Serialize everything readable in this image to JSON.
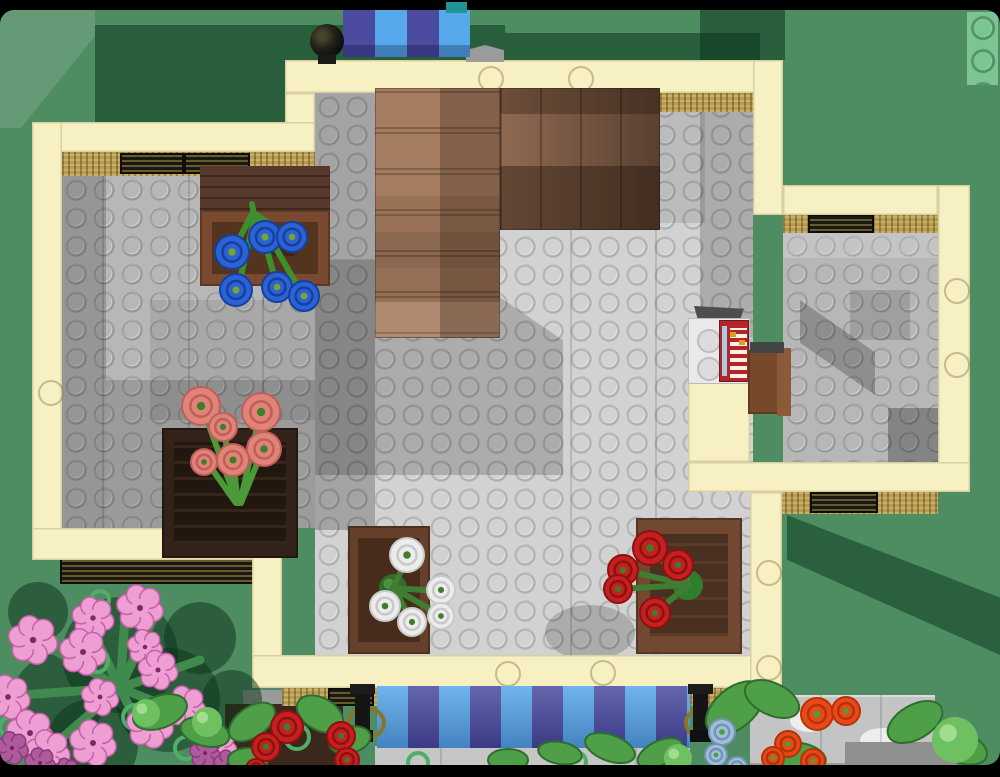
{
  "scene": {
    "title": "Top-down LEGO render of a flower shop ground floor on a green baseplate",
    "palette": {
      "frame_black": "#000000",
      "grass_green": "#4e8c62",
      "grass_shadow_green": "#14502c",
      "grass_light_green": "#7cc492",
      "wall_cream": "#f6f0c3",
      "sill_tan": "#b79a4e",
      "window_slot_dark": "#191814",
      "floor_light_gray": "#d2d2d2",
      "floor_mid_gray": "#b7b7b7",
      "stairs_light_brown": "#a67c60",
      "stairs_dark_brown": "#5a4030",
      "crate_brown": "#6b4128",
      "awning_blue": "#57a8ea",
      "awning_violet": "#4b4ba0",
      "flower_blue": "#2b62d4",
      "flower_pink_rose": "#e08378",
      "flower_white": "#ececec",
      "flower_red": "#c42020",
      "flower_orange": "#e8481a",
      "flower_magenta": "#ef9ed4",
      "flower_light_blue": "#9fc0dc",
      "leaf_green": "#4f9e48",
      "register_red": "#b22528",
      "register_white": "#e9e9e9"
    },
    "objects": [
      "green studded baseplate",
      "cream shop walls",
      "gray tiled floor",
      "L-shaped brown staircase",
      "table with blue flowers",
      "crate with pink roses",
      "crate with white roses",
      "crate with red roses",
      "red cash register on counter",
      "wooden stool",
      "blue and violet striped awnings",
      "black street lamps",
      "pink blossom bush",
      "orange flowers",
      "light blue flowers",
      "stone wall"
    ],
    "flower_counts": {
      "blue": 6,
      "pink_roses": 6,
      "white": 5,
      "red_in_crate": 5,
      "red_outside": 5,
      "pink_blossoms": 14,
      "purple_blossoms": 5,
      "orange": 5,
      "light_blue": 3
    }
  },
  "clusters": [
    {
      "name": "bush-ground-shadow",
      "type": "blob",
      "color": "rgba(10,48,24,0.5)",
      "items": [
        [
          120,
          655,
          58
        ],
        [
          58,
          700,
          46
        ],
        [
          168,
          700,
          52
        ],
        [
          92,
          745,
          46
        ],
        [
          200,
          638,
          36
        ],
        [
          38,
          612,
          30
        ],
        [
          232,
          700,
          30
        ]
      ]
    },
    {
      "name": "bush-branches",
      "type": "branch",
      "color": "#3f8a4c",
      "width": 9,
      "items": [
        [
          120,
          688,
          40,
          642
        ],
        [
          120,
          688,
          88,
          622
        ],
        [
          120,
          688,
          155,
          615
        ],
        [
          120,
          688,
          200,
          660
        ],
        [
          120,
          688,
          196,
          718
        ],
        [
          120,
          688,
          148,
          745
        ],
        [
          120,
          688,
          62,
          738
        ],
        [
          120,
          688,
          20,
          695
        ],
        [
          120,
          688,
          126,
          602
        ]
      ]
    },
    {
      "name": "plant-rings",
      "type": "ring",
      "color": "#4fae68",
      "width": 4,
      "items": [
        [
          97,
          661,
          11
        ],
        [
          135,
          717,
          12
        ],
        [
          186,
          748,
          11
        ],
        [
          10,
          727,
          10
        ],
        [
          100,
          600,
          9
        ],
        [
          297,
          737,
          12
        ],
        [
          418,
          763,
          10
        ],
        [
          576,
          762,
          10
        ],
        [
          652,
          768,
          9
        ]
      ]
    },
    {
      "name": "pink-blossoms",
      "type": "daisy",
      "color": "#ef9ed4",
      "ring": "#c560a8",
      "hole": "#7c2a66",
      "items": [
        [
          140,
          608,
          20
        ],
        [
          93,
          618,
          18
        ],
        [
          33,
          640,
          21
        ],
        [
          83,
          652,
          20
        ],
        [
          145,
          647,
          15
        ],
        [
          158,
          670,
          17
        ],
        [
          8,
          697,
          19
        ],
        [
          100,
          697,
          16
        ],
        [
          185,
          707,
          18
        ],
        [
          150,
          725,
          20
        ],
        [
          30,
          733,
          20
        ],
        [
          93,
          743,
          20
        ],
        [
          48,
          752,
          19
        ],
        [
          217,
          747,
          17
        ]
      ]
    },
    {
      "name": "purple-blossoms",
      "type": "daisy",
      "color": "#b05a9e",
      "ring": "#8a3a78",
      "hole": "#6e2858",
      "items": [
        [
          12,
          748,
          14
        ],
        [
          40,
          763,
          13
        ],
        [
          205,
          753,
          13
        ],
        [
          228,
          764,
          12
        ],
        [
          66,
          771,
          11
        ]
      ]
    },
    {
      "name": "leaves",
      "type": "leaf",
      "color": "#4f9e48",
      "stroke": "#2d6e30",
      "items": [
        [
          160,
          712,
          28,
          16,
          -20
        ],
        [
          205,
          732,
          25,
          14,
          15
        ],
        [
          252,
          722,
          26,
          15,
          -35
        ],
        [
          320,
          714,
          25,
          16,
          30
        ],
        [
          350,
          740,
          21,
          13,
          -15
        ],
        [
          610,
          748,
          26,
          13,
          20
        ],
        [
          660,
          753,
          24,
          12,
          -25
        ],
        [
          735,
          708,
          34,
          20,
          -40
        ],
        [
          772,
          699,
          29,
          16,
          25
        ],
        [
          800,
          757,
          26,
          14,
          10
        ],
        [
          915,
          722,
          30,
          17,
          -30
        ],
        [
          962,
          748,
          26,
          15,
          20
        ],
        [
          508,
          760,
          20,
          11,
          0
        ],
        [
          560,
          753,
          22,
          11,
          10
        ],
        [
          248,
          760,
          20,
          12,
          0
        ]
      ]
    },
    {
      "name": "leaf-balls",
      "type": "ball",
      "color": "#6fc060",
      "hi": "#a2dc8e",
      "items": [
        [
          955,
          740,
          23
        ],
        [
          207,
          722,
          15
        ],
        [
          146,
          713,
          14
        ],
        [
          678,
          758,
          14
        ]
      ]
    },
    {
      "name": "blue-flower-stems",
      "type": "branch",
      "color": "#3f8f2f",
      "width": 6,
      "items": [
        [
          253,
          212,
          233,
          251
        ],
        [
          255,
          214,
          289,
          238
        ],
        [
          255,
          216,
          238,
          288
        ],
        [
          258,
          218,
          277,
          286
        ],
        [
          260,
          220,
          302,
          294
        ],
        [
          252,
          204,
          256,
          226
        ]
      ]
    },
    {
      "name": "blue-flowers",
      "type": "rose",
      "color": "#2b62d4",
      "ring": "#163f9e",
      "center": "#79a52c",
      "items": [
        [
          232,
          252,
          17
        ],
        [
          265,
          237,
          16
        ],
        [
          292,
          237,
          15
        ],
        [
          236,
          290,
          16
        ],
        [
          277,
          287,
          15
        ],
        [
          304,
          296,
          15
        ]
      ]
    },
    {
      "name": "pink-rose-stems",
      "type": "branch",
      "color": "#4a9a37",
      "width": 6,
      "items": [
        [
          237,
          503,
          203,
          409
        ],
        [
          238,
          503,
          223,
          428
        ],
        [
          240,
          503,
          260,
          414
        ],
        [
          241,
          503,
          263,
          449
        ],
        [
          238,
          503,
          233,
          460
        ],
        [
          236,
          503,
          207,
          462
        ]
      ]
    },
    {
      "name": "pink-roses",
      "type": "rose",
      "color": "#e08378",
      "ring": "#bf5f58",
      "center": "#3e7d2a",
      "items": [
        [
          201,
          406,
          19
        ],
        [
          223,
          427,
          14
        ],
        [
          261,
          412,
          19
        ],
        [
          264,
          449,
          17
        ],
        [
          233,
          460,
          16
        ],
        [
          204,
          462,
          13
        ]
      ]
    },
    {
      "name": "white-flower-hub",
      "type": "ball",
      "color": "#2f6e2a",
      "hi": "#4e8f45",
      "items": [
        [
          393,
          588,
          14
        ]
      ]
    },
    {
      "name": "white-flower-stems",
      "type": "branch",
      "color": "#3f7d33",
      "width": 6,
      "items": [
        [
          393,
          588,
          408,
          556
        ],
        [
          393,
          588,
          439,
          591
        ],
        [
          393,
          588,
          386,
          606
        ],
        [
          395,
          590,
          412,
          622
        ],
        [
          397,
          590,
          440,
          615
        ]
      ]
    },
    {
      "name": "white-roses",
      "type": "rose",
      "color": "#ececec",
      "ring": "#c9c9c9",
      "center": "#3e7d2a",
      "items": [
        [
          407,
          555,
          17
        ],
        [
          441,
          590,
          14
        ],
        [
          385,
          606,
          15
        ],
        [
          412,
          622,
          14
        ],
        [
          441,
          616,
          13
        ]
      ]
    },
    {
      "name": "red-flower-hub",
      "type": "ball",
      "color": "#2f7d2f",
      "hi": "#4fa04a",
      "items": [
        [
          688,
          585,
          15
        ]
      ]
    },
    {
      "name": "red-flower-stems",
      "type": "branch",
      "color": "#3f7d33",
      "width": 6,
      "items": [
        [
          688,
          585,
          651,
          549
        ],
        [
          688,
          585,
          624,
          570
        ],
        [
          688,
          585,
          678,
          566
        ],
        [
          685,
          585,
          619,
          589
        ],
        [
          686,
          587,
          656,
          612
        ]
      ]
    },
    {
      "name": "red-roses",
      "type": "rose",
      "color": "#c42020",
      "ring": "#8f1010",
      "center": "#3e7d2a",
      "items": [
        [
          650,
          548,
          17
        ],
        [
          623,
          570,
          15
        ],
        [
          678,
          565,
          15
        ],
        [
          618,
          589,
          14
        ],
        [
          655,
          613,
          15
        ]
      ]
    },
    {
      "name": "red-roses-street",
      "type": "rose",
      "color": "#c42020",
      "ring": "#8f1010",
      "center": "#3e7d2a",
      "items": [
        [
          287,
          727,
          16
        ],
        [
          266,
          747,
          14
        ],
        [
          341,
          736,
          14
        ],
        [
          347,
          760,
          12
        ],
        [
          256,
          769,
          10
        ]
      ]
    },
    {
      "name": "orange-flowers",
      "type": "rose",
      "color": "#e8481a",
      "ring": "#b53305",
      "center": "#4e9e3e",
      "items": [
        [
          817,
          714,
          16
        ],
        [
          846,
          711,
          14
        ],
        [
          788,
          744,
          13
        ],
        [
          773,
          758,
          11
        ],
        [
          813,
          761,
          12
        ]
      ]
    },
    {
      "name": "light-blue-flowers",
      "type": "rose",
      "color": "#9fc0dc",
      "ring": "#7693b5",
      "center": "#4e9e3e",
      "items": [
        [
          722,
          732,
          13
        ],
        [
          716,
          755,
          11
        ],
        [
          737,
          767,
          10
        ]
      ]
    }
  ]
}
